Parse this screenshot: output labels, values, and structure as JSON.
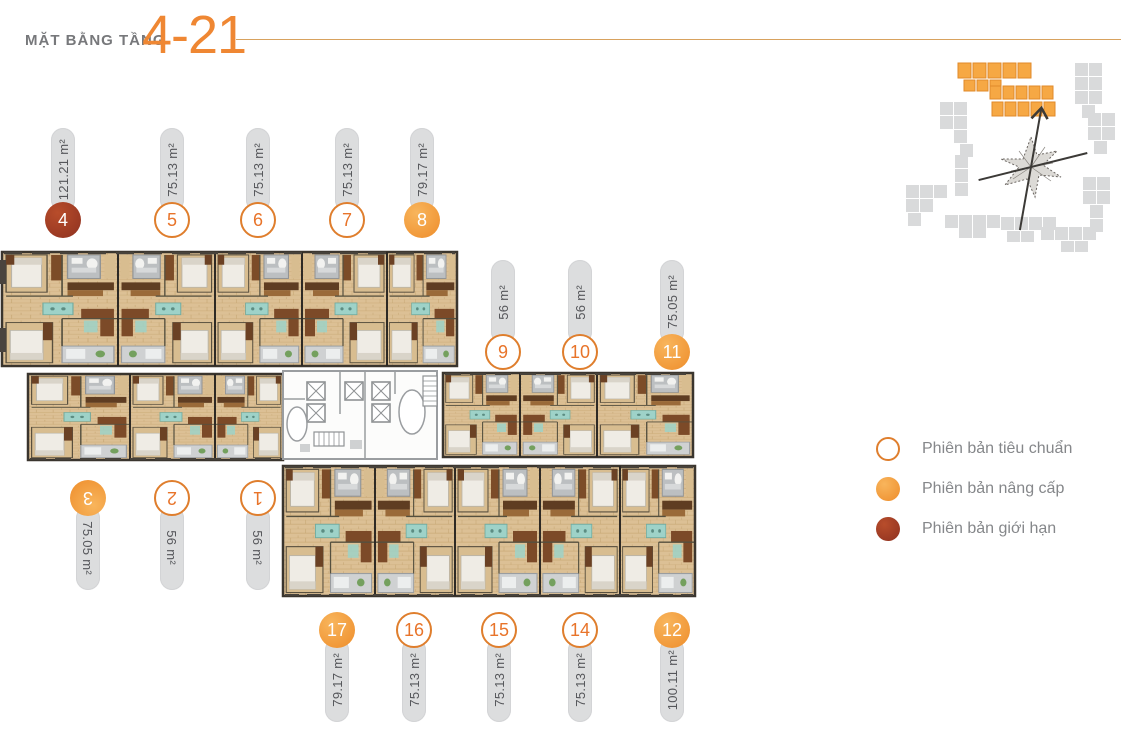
{
  "header": {
    "title_prefix": "MẶT BẰNG TẦNG",
    "title_floor_range": "4-21"
  },
  "units": [
    {
      "id": "4",
      "area": "121.21 m²",
      "variant": "limited",
      "orientation": "up",
      "cx": 63,
      "top": 128
    },
    {
      "id": "5",
      "area": "75.13 m²",
      "variant": "standard",
      "orientation": "up",
      "cx": 172,
      "top": 128
    },
    {
      "id": "6",
      "area": "75.13 m²",
      "variant": "standard",
      "orientation": "up",
      "cx": 258,
      "top": 128
    },
    {
      "id": "7",
      "area": "75.13 m²",
      "variant": "standard",
      "orientation": "up",
      "cx": 347,
      "top": 128
    },
    {
      "id": "8",
      "area": "79.17 m²",
      "variant": "upgrade",
      "orientation": "up",
      "cx": 422,
      "top": 128
    },
    {
      "id": "9",
      "area": "56 m²",
      "variant": "standard",
      "orientation": "up",
      "cx": 503,
      "top": 260
    },
    {
      "id": "10",
      "area": "56 m²",
      "variant": "standard",
      "orientation": "up",
      "cx": 580,
      "top": 260
    },
    {
      "id": "11",
      "area": "75.05 m²",
      "variant": "upgrade",
      "orientation": "up",
      "cx": 672,
      "top": 260
    },
    {
      "id": "3",
      "area": "75.05 m²",
      "variant": "upgrade",
      "orientation": "flip",
      "cx": 88,
      "top": 480
    },
    {
      "id": "2",
      "area": "56 m²",
      "variant": "standard",
      "orientation": "flip",
      "cx": 172,
      "top": 480
    },
    {
      "id": "1",
      "area": "56 m²",
      "variant": "standard",
      "orientation": "flip",
      "cx": 258,
      "top": 480
    },
    {
      "id": "17",
      "area": "79.17 m²",
      "variant": "upgrade",
      "orientation": "down",
      "cx": 337,
      "top": 612
    },
    {
      "id": "16",
      "area": "75.13 m²",
      "variant": "standard",
      "orientation": "down",
      "cx": 414,
      "top": 612
    },
    {
      "id": "15",
      "area": "75.13 m²",
      "variant": "standard",
      "orientation": "down",
      "cx": 499,
      "top": 612
    },
    {
      "id": "14",
      "area": "75.13 m²",
      "variant": "standard",
      "orientation": "down",
      "cx": 580,
      "top": 612
    },
    {
      "id": "12",
      "area": "100.11 m²",
      "variant": "upgrade",
      "orientation": "down",
      "cx": 672,
      "top": 612
    }
  ],
  "legend": {
    "items": [
      {
        "label": "Phiên bản tiêu chuẩn",
        "variant": "standard"
      },
      {
        "label": "Phiên bản nâng cấp",
        "variant": "upgrade"
      },
      {
        "label": "Phiên bản giới hạn",
        "variant": "limited"
      }
    ]
  },
  "colors": {
    "accent_orange": "#EF8733",
    "standard_ring": "#DF7E2D",
    "upgrade_fill": "#F2993B",
    "limited_fill": "#A23A22",
    "pill_bg": "#DCDDDE",
    "pill_text": "#55565A",
    "legend_text": "#85878A",
    "rule_line": "#D8A25E"
  }
}
